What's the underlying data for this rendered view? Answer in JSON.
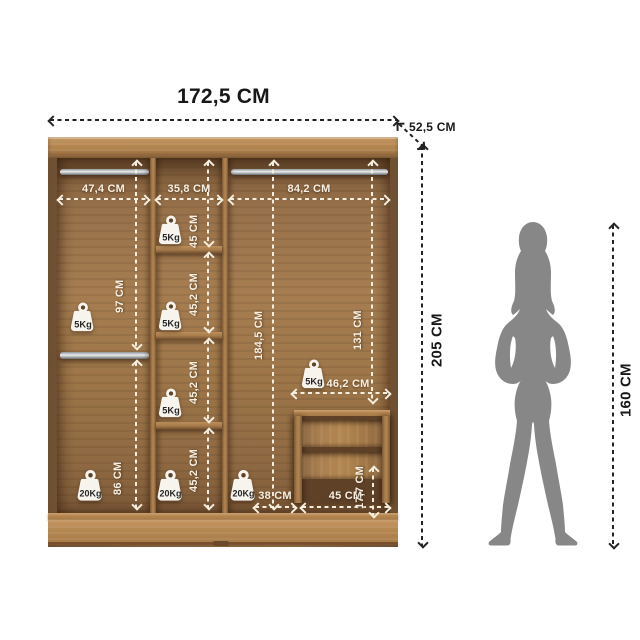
{
  "overall": {
    "width": "172,5 CM",
    "depth": "52,5 CM",
    "height": "205 CM"
  },
  "person": {
    "height": "160 CM"
  },
  "sections": {
    "left": {
      "width": "47,4 CM",
      "upper_height": "97 CM",
      "lower_height": "86 CM",
      "upper_capacity": "5Kg",
      "lower_capacity": "20Kg"
    },
    "middle": {
      "width": "35,8 CM",
      "compartments": [
        {
          "height": "45 CM",
          "capacity": "5Kg"
        },
        {
          "height": "45,2 CM",
          "capacity": "5Kg"
        },
        {
          "height": "45,2 CM",
          "capacity": "5Kg"
        },
        {
          "height": "45,2 CM",
          "capacity": "20Kg"
        }
      ]
    },
    "right": {
      "width": "84,2 CM",
      "full_height": "184,5 CM",
      "upper_height": "131 CM",
      "capacity": "5Kg",
      "floor_capacity": "20Kg",
      "floor_gap_width": "38 CM"
    },
    "drawers": {
      "top_width": "46,2 CM",
      "width": "45 CM",
      "drawer_height": "17,7 CM"
    }
  },
  "icons": {
    "weight_5kg": "weight-5kg-icon",
    "weight_20kg": "weight-20kg-icon"
  },
  "colors": {
    "wood_light": "#b3854f",
    "wood_mid": "#9b744a",
    "wood_dark": "#7b5838",
    "annotation_light": "#f5eddd",
    "annotation_dark": "#232323",
    "silhouette": "#878787",
    "rail": "#c9ccce"
  }
}
